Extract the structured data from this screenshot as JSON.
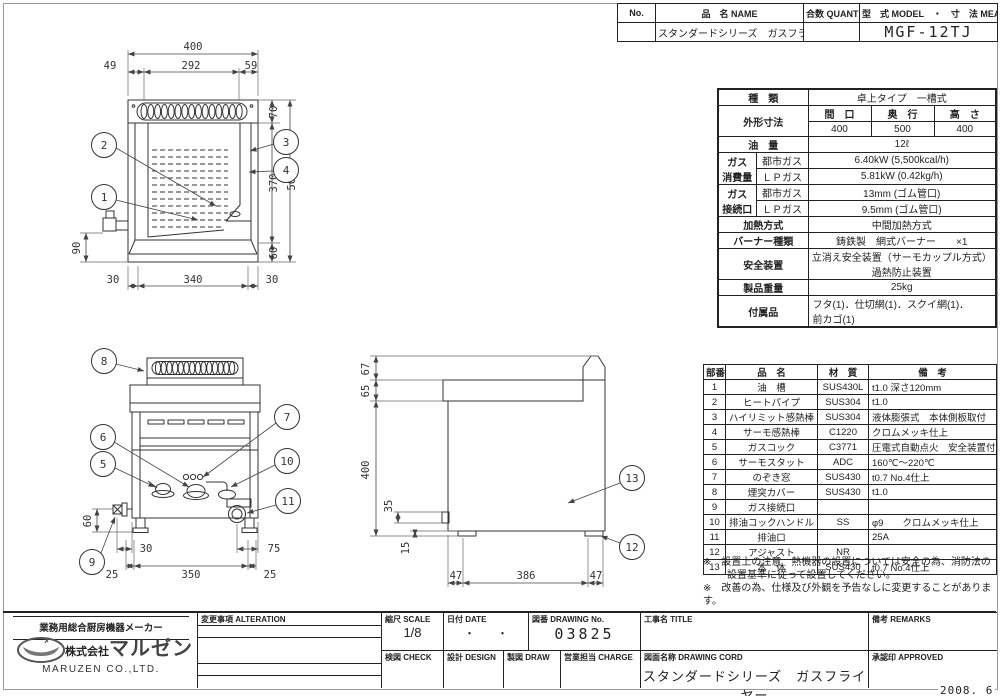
{
  "sheet": {
    "date": "2008. 6"
  },
  "title_block": {
    "no_label": "No.",
    "name_label": "品　名 NAME",
    "qty_label": "合数 QUANTITY",
    "model_label": "型　式 MODEL　・　寸　法 MEASUR",
    "name_value": "スタンダードシリーズ　ガスフライヤー",
    "model_value": "MGF-12TJ"
  },
  "spec": {
    "kind_label": "種　類",
    "kind_value": "卓上タイプ　一槽式",
    "dims_label": "外形寸法",
    "w_label": "間　口",
    "d_label": "奥　行",
    "h_label": "高　さ",
    "w": "400",
    "d": "500",
    "h": "400",
    "oil_label": "油　量",
    "oil_value": "12ℓ",
    "gas1_label_a": "ガス",
    "gas1_label_b": "消費量",
    "gas2_label_a": "ガス",
    "gas2_label_b": "接続口",
    "city_label1": "都市ガス",
    "lp_label1": "ＬＰガス",
    "city_label2": "都市ガス",
    "lp_label2": "ＬＰガス",
    "consumption_city": "6.40kW (5,500kcal/h)",
    "consumption_lp": "5.81kW (0.42kg/h)",
    "port_city": "13mm (ゴム管口)",
    "port_lp": "9.5mm (ゴム管口)",
    "heating_label": "加熱方式",
    "heating_value": "中間加熱方式",
    "burner_label": "バーナー種類",
    "burner_value": "鋳鉄製　網式バーナー　　×1",
    "safety_label": "安全装置",
    "safety_value1": "立消え安全装置（サーモカップル方式）",
    "safety_value2": "過熱防止装置",
    "weight_label": "製品重量",
    "weight_value": "25kg",
    "accessory_label": "付属品",
    "accessory_value1": "フタ(1)．仕切網(1)．スクイ網(1)．",
    "accessory_value2": "前カゴ(1)"
  },
  "parts": {
    "headers": {
      "no": "部番",
      "name": "品　名",
      "material": "材　質",
      "remark": "備　考"
    },
    "rows": [
      {
        "no": "1",
        "name": "油　槽",
        "material": "SUS430L",
        "remark": "t1.0 深さ120mm"
      },
      {
        "no": "2",
        "name": "ヒートパイプ",
        "material": "SUS304",
        "remark": "t1.0"
      },
      {
        "no": "3",
        "name": "ハイリミット感熱棒",
        "material": "SUS304",
        "remark": "液体膨張式　本体側板取付"
      },
      {
        "no": "4",
        "name": "サーモ感熱棒",
        "material": "C1220",
        "remark": "クロムメッキ仕上"
      },
      {
        "no": "5",
        "name": "ガスコック",
        "material": "C3771",
        "remark": "圧電式自動点火　安全装置付"
      },
      {
        "no": "6",
        "name": "サーモスタット",
        "material": "ADC",
        "remark": "160℃～220℃"
      },
      {
        "no": "7",
        "name": "のぞき窓",
        "material": "SUS430",
        "remark": "t0.7 No.4仕上"
      },
      {
        "no": "8",
        "name": "煙突カバー",
        "material": "SUS430",
        "remark": "t1.0"
      },
      {
        "no": "9",
        "name": "ガス接続口",
        "material": "",
        "remark": ""
      },
      {
        "no": "10",
        "name": "排油コックハンドル",
        "material": "SS",
        "remark": "φ9　　クロムメッキ仕上"
      },
      {
        "no": "11",
        "name": "排油口",
        "material": "",
        "remark": "25A"
      },
      {
        "no": "12",
        "name": "アジャスト",
        "material": "NR",
        "remark": ""
      },
      {
        "no": "13",
        "name": "本　体",
        "material": "SUS430",
        "remark": "t0.7 No.4仕上"
      }
    ]
  },
  "notes": {
    "note1_line1": "※　設置上の注意　熱機器の設置については安全の為、消防法の",
    "note1_line2": "設置基準に従って設置してください。",
    "note2": "※　改善の為、仕様及び外観を予告なしに変更することがあります。"
  },
  "footer": {
    "alteration_label": "変更事項 ALTERATION",
    "scale_label": "縮尺 SCALE",
    "scale_value": "1/8",
    "date_label": "日付 DATE",
    "date_value": "・　　・",
    "drawing_no_label": "図番 DRAWING No.",
    "drawing_no_value": "03825",
    "title_label": "工事名 TITLE",
    "remarks_label": "備考 REMARKS",
    "check_label": "検図 CHECK",
    "design_label": "設計 DESIGN",
    "draw_label": "製図 DRAW",
    "charge_label": "営業担当 CHARGE",
    "drawing_name_label": "図面名称 DRAWING CORD",
    "drawing_name_value": "スタンダードシリーズ　ガスフライヤー",
    "approved_label": "承認印 APPROVED"
  },
  "company": {
    "tagline": "業務用総合厨房機器メーカー",
    "name_prefix": "株式会社",
    "name": "マルゼン",
    "name_en": "MARUZEN  CO.,LTD."
  },
  "drawings": {
    "top_view": {
      "d400": "400",
      "d49": "49",
      "d292": "292",
      "d59": "59",
      "d70": "70",
      "d370": "370",
      "d500": "500",
      "d60": "60",
      "d90": "90",
      "d30l": "30",
      "d340": "340",
      "d30r": "30"
    },
    "front_view": {
      "d60": "60",
      "d30": "30",
      "d75": "75",
      "d25l": "25",
      "d350": "350",
      "d25r": "25"
    },
    "side_view": {
      "d67": "67",
      "d65": "65",
      "d400": "400",
      "d35": "35",
      "d15": "15",
      "d47l": "47",
      "d386": "386",
      "d47r": "47"
    },
    "callouts": {
      "c1": "1",
      "c2": "2",
      "c3": "3",
      "c4": "4",
      "c5": "5",
      "c6": "6",
      "c7": "7",
      "c8": "8",
      "c9": "9",
      "c10": "10",
      "c11": "11",
      "c12": "12",
      "c13": "13"
    }
  }
}
